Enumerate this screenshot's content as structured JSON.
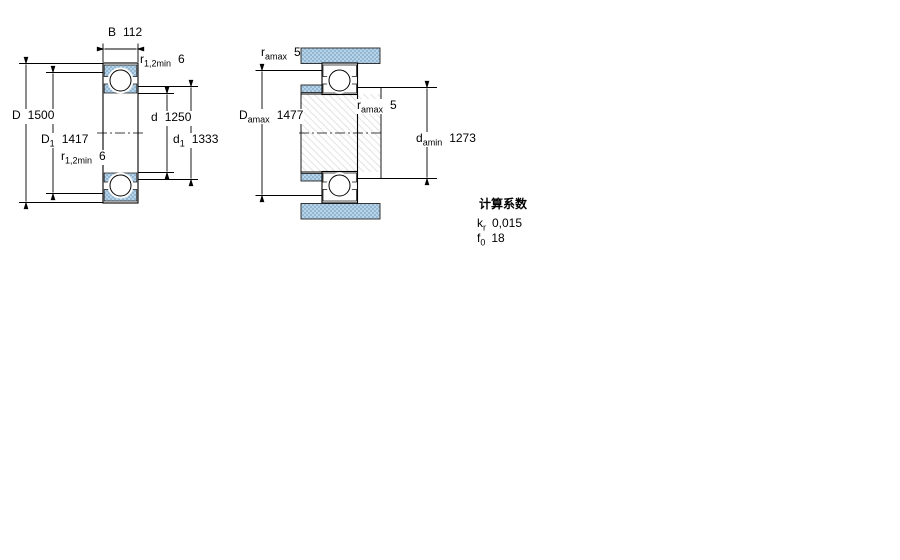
{
  "drawing": {
    "fig1": {
      "name": "bearing-cross-section-boundary-dimensions",
      "labels": {
        "B": {
          "main": "B",
          "sub": "",
          "value": "112"
        },
        "r12_top": {
          "main": "r",
          "sub": "1,2min",
          "value": "6"
        },
        "D": {
          "main": "D",
          "sub": "",
          "value": "1500"
        },
        "D1": {
          "main": "D",
          "sub": "1",
          "value": "1417"
        },
        "r12_bottom": {
          "main": "r",
          "sub": "1,2min",
          "value": "6"
        },
        "d": {
          "main": "d",
          "sub": "",
          "value": "1250"
        },
        "d1": {
          "main": "d",
          "sub": "1",
          "value": "1333"
        }
      }
    },
    "fig2": {
      "name": "bearing-abutment-fillet-dimensions",
      "labels": {
        "ra_top": {
          "main": "r",
          "sub": "amax",
          "value": "5"
        },
        "Damax": {
          "main": "D",
          "sub": "amax",
          "value": "1477"
        },
        "ra_mid": {
          "main": "r",
          "sub": "amax",
          "value": "5"
        },
        "damin": {
          "main": "d",
          "sub": "amin",
          "value": "1273"
        }
      }
    }
  },
  "calculation_factors": {
    "title": "计算系数",
    "rows": [
      {
        "main": "k",
        "sub": "r",
        "value": "0,015"
      },
      {
        "main": "f",
        "sub": "0",
        "value": "18"
      }
    ]
  },
  "colors": {
    "steel_light": "#b7d3e7",
    "steel_dark": "#93b7d3",
    "outline": "#000000",
    "shaft_hatch": "#e4e4e4",
    "background": "#ffffff"
  }
}
